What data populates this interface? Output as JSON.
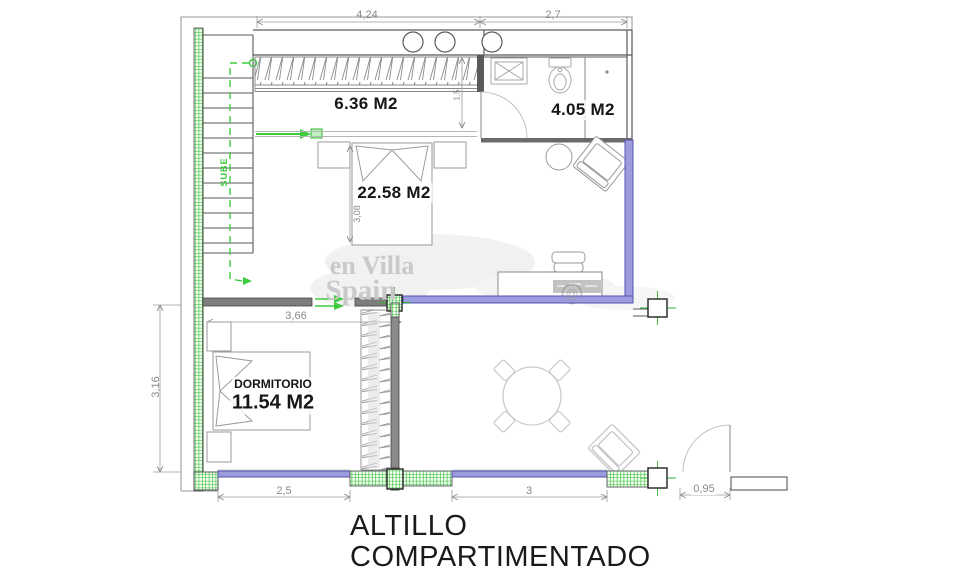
{
  "plan": {
    "title_line1": "ALTILLO",
    "title_line2": "COMPARTIMENTADO",
    "watermark": {
      "line1": "en Villa",
      "line2": "Spain",
      "at_symbol": "@"
    },
    "stairs": {
      "direction_label": "SUBE"
    },
    "rooms": {
      "walkin_closet": {
        "area_label": "6.36 M2"
      },
      "bathroom": {
        "area_label": "4.05 M2"
      },
      "main_room": {
        "area_label": "22.58 M2"
      },
      "dormitorio": {
        "name_label": "DORMITORIO",
        "area_label": "11.54 M2"
      }
    },
    "dimensions": {
      "top_left": "4,24",
      "top_right": "2,7",
      "closet_depth": "1,5",
      "bed_length": "3,08",
      "dormitorio_width": "3,66",
      "dormitorio_depth": "3,16",
      "window_left": "2,5",
      "window_right": "3",
      "door_right": "0,95"
    },
    "colors": {
      "walls": "#4d4d4d",
      "furniture": "#9a9a9a",
      "glazing_fill": "#9b9bdd",
      "glazing_stroke": "#5353ad",
      "green_marks": "#2eb82e",
      "dimension_text": "#8a8a8a",
      "title_text": "#1a1a1a",
      "watermark_text": "#c9c9c9"
    }
  }
}
